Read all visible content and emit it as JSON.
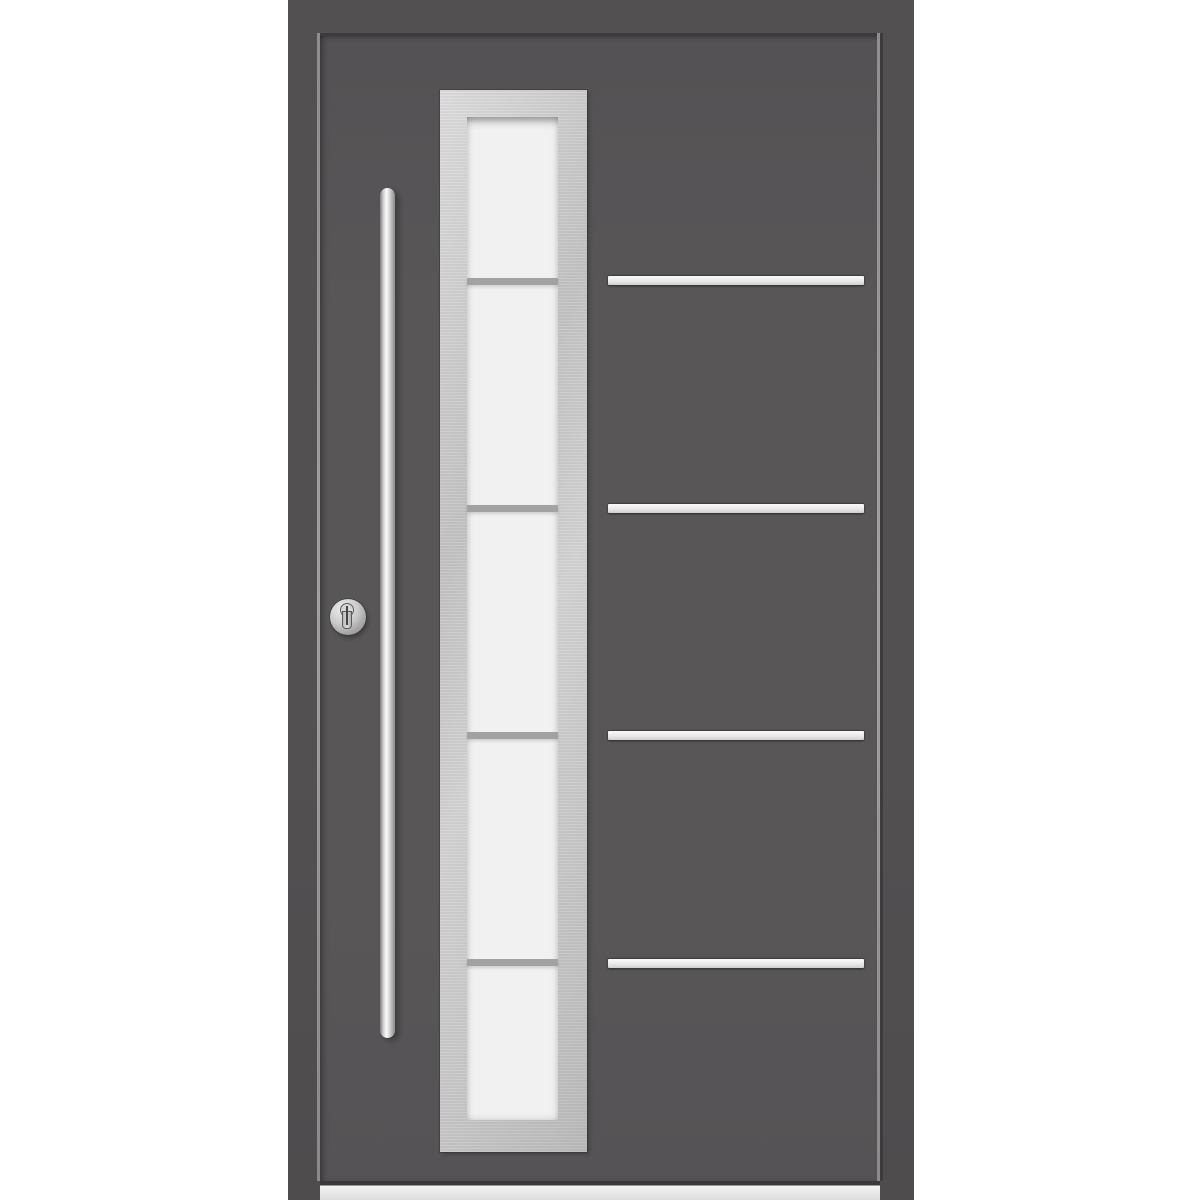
{
  "image": {
    "type": "product-photo",
    "subject": "Modern aluminium front entrance door, front view",
    "background_color": "#ffffff"
  },
  "door": {
    "finish": "anthracite-grey",
    "frame_color": "#525051",
    "leaf_color": "#585657",
    "gap_shadow_color": "#3d3b3c",
    "gap_highlight_color": "#908e8f",
    "threshold_color": "#ececec"
  },
  "glazing": {
    "surround_material": "brushed-stainless-steel",
    "surround_color": "#c6c6c6",
    "glass_finish": "frosted-white",
    "glass_color": "#f1f1f1",
    "section_count": 5,
    "divider_count": 4,
    "divider_color": "#a3a1a2",
    "divider_offsets_px": [
      161,
      388,
      615,
      842
    ]
  },
  "decor_strips": {
    "count": 4,
    "material": "stainless-steel-inlay",
    "color": "#e9e9e9",
    "y_positions_px": [
      276,
      504,
      731,
      959
    ]
  },
  "hardware": {
    "handle": {
      "kind": "vertical-bar-pull-handle",
      "material": "stainless-steel",
      "color": "#d8d8d8"
    },
    "lock": {
      "kind": "euro-cylinder-with-round-escutcheon",
      "color": "#c9c9c9"
    }
  }
}
